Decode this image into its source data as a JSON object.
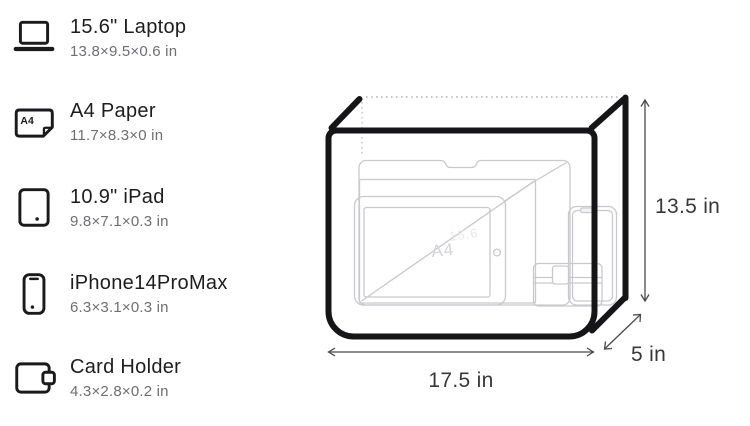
{
  "capacity_list": {
    "items": [
      {
        "icon": "laptop-icon",
        "name": "15.6\" Laptop",
        "dims": "13.8×9.5×0.6 in"
      },
      {
        "icon": "a4-paper-icon",
        "name": "A4 Paper",
        "dims": "11.7×8.3×0 in",
        "icon_label": "A4"
      },
      {
        "icon": "ipad-icon",
        "name": "10.9\" iPad",
        "dims": "9.8×7.1×0.3 in"
      },
      {
        "icon": "iphone-icon",
        "name": "iPhone14ProMax",
        "dims": "6.3×3.1×0.3 in"
      },
      {
        "icon": "card-holder-icon",
        "name": "Card Holder",
        "dims": "4.3×2.8×0.2 in"
      }
    ]
  },
  "diagram": {
    "width_label": "17.5 in",
    "height_label": "13.5 in",
    "depth_label": "5 in",
    "watermarks": {
      "a4": "A4",
      "laptop": "15.6"
    }
  },
  "colors": {
    "outline": "#151517",
    "item_stroke": "#c9c9cd",
    "dotted_edge": "#b6b6ba",
    "arrow": "#4a4a4c",
    "title_text": "#1d1d1f",
    "dims_text": "#6e6e73",
    "label_text": "#38383a"
  }
}
